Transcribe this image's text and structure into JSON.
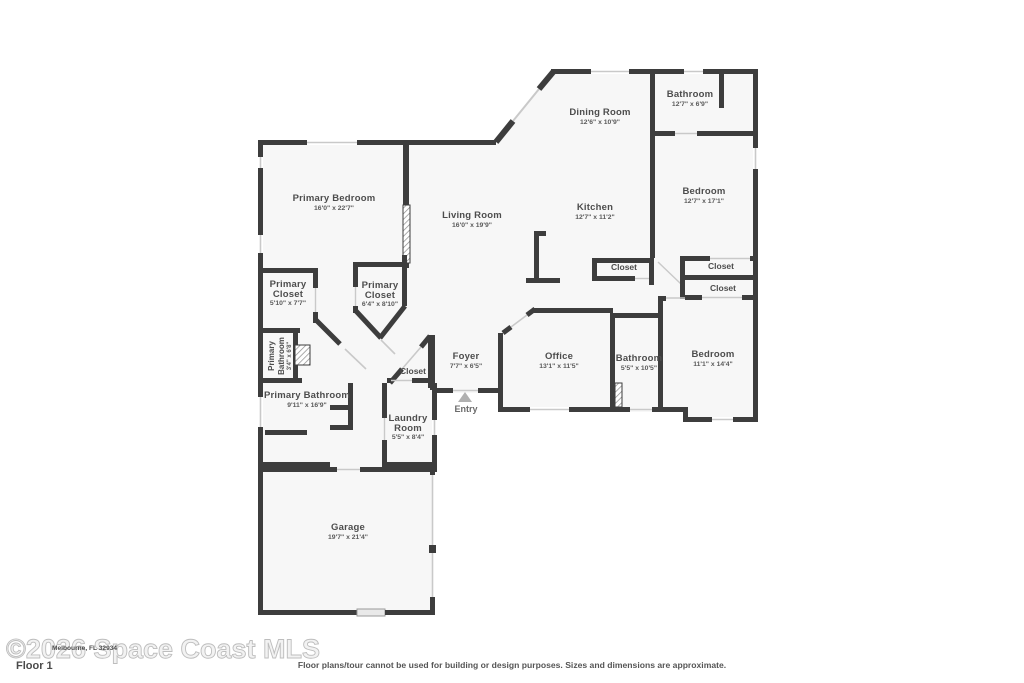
{
  "meta": {
    "wall_color": "#3d3d3d",
    "room_fill": "#f7f7f7",
    "window_color": "#c9c9c9",
    "entry_marker_color": "#b0b0b0"
  },
  "rooms": [
    {
      "name": "Bathroom",
      "dims": "12'7\" x 6'9\""
    },
    {
      "name": "Dining Room",
      "dims": "12'6\" x 10'9\""
    },
    {
      "name": "Bedroom",
      "dims": "12'7\" x 17'1\""
    },
    {
      "name": "Primary Bedroom",
      "dims": "16'0\" x 22'7\""
    },
    {
      "name": "Living Room",
      "dims": "16'0\" x 19'9\""
    },
    {
      "name": "Kitchen",
      "dims": "12'7\" x 11'2\""
    },
    {
      "name": "Closet"
    },
    {
      "name": "Closet"
    },
    {
      "name": "Closet"
    },
    {
      "line1": "Primary",
      "line2": "Closet",
      "dims": "5'10\" x 7'7\""
    },
    {
      "line1": "Primary",
      "line2": "Closet",
      "dims": "6'4\" x 8'10\""
    },
    {
      "line1": "Primary",
      "line2": "Bathroom",
      "dims": "3'4\" x 6'8\""
    },
    {
      "name": "Closet"
    },
    {
      "name": "Foyer",
      "dims": "7'7\" x 6'5\""
    },
    {
      "name": "Office",
      "dims": "13'1\" x 11'5\""
    },
    {
      "name": "Bathroom",
      "dims": "5'5\" x 10'5\""
    },
    {
      "name": "Bedroom",
      "dims": "11'1\" x 14'4\""
    },
    {
      "name": "Primary Bathroom",
      "dims": "9'11\" x 16'9\""
    },
    {
      "line1": "Laundry",
      "line2": "Room",
      "dims": "5'5\" x 8'4\""
    },
    {
      "name": "Garage",
      "dims": "19'7\" x 21'4\""
    }
  ],
  "entry_label": "Entry",
  "footer": {
    "floor_label": "Floor 1",
    "watermark": "©2026 Space Coast MLS",
    "address_overlay": "Melbourne, FL 32934",
    "disclaimer": "Floor plans/tour cannot be used for building or design purposes. Sizes and dimensions are approximate."
  }
}
